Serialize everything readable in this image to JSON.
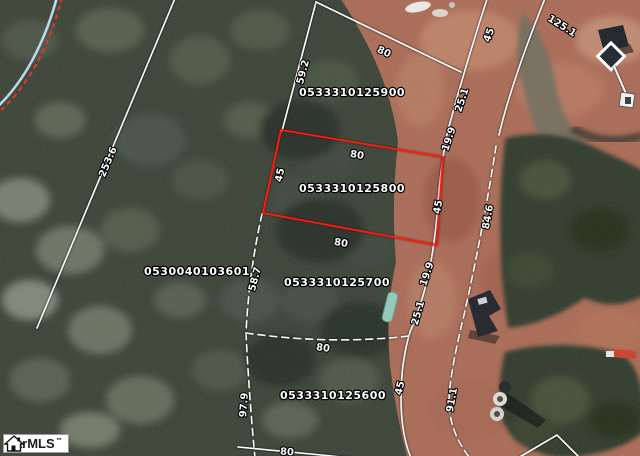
{
  "page": {
    "width": 640,
    "height": 456,
    "kind": "gis-parcel-aerial-map"
  },
  "watermark": {
    "name": "garMLS",
    "trademark": "™"
  },
  "map": {
    "colors": {
      "parcel_line": "#ffffff",
      "highlight_parcel": "#ff1a0e",
      "stream": "#b9d8e8",
      "stream_dash": "#e2352b",
      "dirt": "#aa6c57",
      "forest": "#3d4539",
      "label_fill": "#ffffff",
      "label_halo": "#000000"
    },
    "parcel_labels": [
      {
        "text": "0533310125900",
        "x": 352,
        "y": 96,
        "highlighted": false
      },
      {
        "text": "0533310125800",
        "x": 352,
        "y": 192,
        "highlighted": true
      },
      {
        "text": "0530040103601",
        "x": 197,
        "y": 275,
        "highlighted": false
      },
      {
        "text": "0533310125700",
        "x": 337,
        "y": 286,
        "highlighted": false
      },
      {
        "text": "0533310125600",
        "x": 333,
        "y": 399,
        "highlighted": false
      }
    ],
    "dimension_labels": [
      {
        "text": "80",
        "x": 384,
        "y": 52,
        "rot": 24
      },
      {
        "text": "59.2",
        "x": 303,
        "y": 72,
        "rot": -75
      },
      {
        "text": "253.6",
        "x": 108,
        "y": 162,
        "rot": -67
      },
      {
        "text": "45",
        "x": 280,
        "y": 175,
        "rot": -78
      },
      {
        "text": "80",
        "x": 357,
        "y": 155,
        "rot": 9
      },
      {
        "text": "80",
        "x": 341,
        "y": 243,
        "rot": 9
      },
      {
        "text": "45",
        "x": 438,
        "y": 207,
        "rot": -80
      },
      {
        "text": "19.9",
        "x": 449,
        "y": 139,
        "rot": -72
      },
      {
        "text": "25.1",
        "x": 462,
        "y": 100,
        "rot": -72
      },
      {
        "text": "45",
        "x": 489,
        "y": 35,
        "rot": -70
      },
      {
        "text": "125.1",
        "x": 562,
        "y": 26,
        "rot": 32
      },
      {
        "text": "84.6",
        "x": 488,
        "y": 217,
        "rot": -80
      },
      {
        "text": "19.9",
        "x": 427,
        "y": 274,
        "rot": -72
      },
      {
        "text": "25.1",
        "x": 418,
        "y": 313,
        "rot": -74
      },
      {
        "text": "58.7",
        "x": 255,
        "y": 279,
        "rot": -75
      },
      {
        "text": "97.9",
        "x": 244,
        "y": 405,
        "rot": -86
      },
      {
        "text": "80",
        "x": 323,
        "y": 348,
        "rot": 7
      },
      {
        "text": "45",
        "x": 400,
        "y": 388,
        "rot": -76
      },
      {
        "text": "91.1",
        "x": 452,
        "y": 400,
        "rot": -80
      },
      {
        "text": "80",
        "x": 287,
        "y": 452,
        "rot": 4
      }
    ],
    "boundary_lines": [
      {
        "name": "boundary-diagonal-nw",
        "d": "M176,-4 L37,328",
        "dash": false,
        "kind": "parcel"
      },
      {
        "name": "parcel-900-west-line",
        "d": "M316,2 L282,131",
        "dash": false,
        "kind": "parcel"
      },
      {
        "name": "parcel-900-north-line",
        "d": "M316,2 L461,72",
        "dash": false,
        "kind": "parcel"
      },
      {
        "name": "road-inner-edge",
        "d": "M488,-4 Q467,60 448,130 Q441,160 437,215 Q431,285 410,332 Q401,362 401,398 Q401,434 411,458",
        "dash": false,
        "kind": "parcel"
      },
      {
        "name": "road-outer-edge",
        "d": "M546,-4 Q522,55 507,105 Q502,122 499,135",
        "dash": false,
        "kind": "parcel"
      },
      {
        "name": "road-mid-line",
        "d": "M496,146 Q484,225 464,315 Q450,372 449,400 Q449,432 470,458",
        "dash": true,
        "kind": "parcel"
      },
      {
        "name": "parcel-west-dashed-line",
        "d": "M262,214 Q249,272 246,333 Q249,395 255,458",
        "dash": true,
        "kind": "parcel"
      },
      {
        "name": "parcel-600-north-line",
        "d": "M246,333 Q330,345 409,336",
        "dash": true,
        "kind": "parcel"
      },
      {
        "name": "bottom-parcel-line",
        "d": "M238,447 L352,458",
        "dash": false,
        "kind": "parcel"
      },
      {
        "name": "bottom-triangle-line",
        "d": "M518,458 L557,435 L580,458",
        "dash": false,
        "kind": "parcel"
      },
      {
        "name": "highlighted-parcel-outline",
        "d": "M281,130 L443,157 L437,245 L263,213 Z",
        "dash": false,
        "kind": "highlight"
      }
    ],
    "stream": {
      "water_d": "M57,-3 Q47,35 28,68 Q12,94 -4,108",
      "dash_d": "M62,-3 Q52,37 33,70 Q17,96 1,110"
    }
  }
}
